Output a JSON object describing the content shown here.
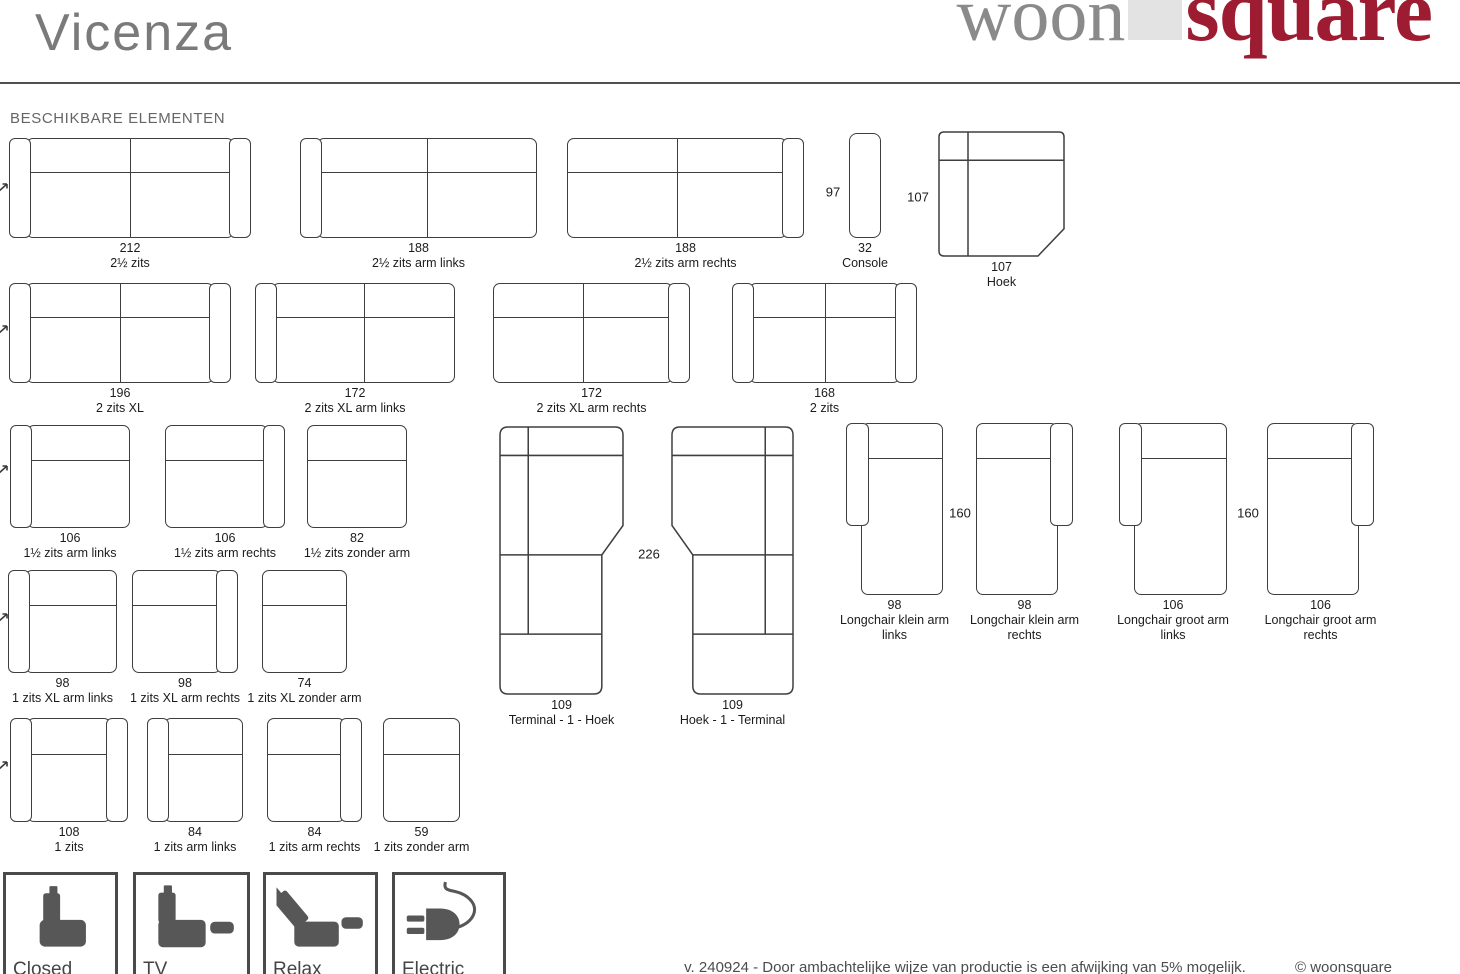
{
  "page": {
    "title": "Vicenza",
    "section_heading": "BESCHIKBARE ELEMENTEN"
  },
  "logo": {
    "part1": "woon",
    "part2": "square",
    "part1_color": "#8a8a8a",
    "part2_color": "#9d1c31",
    "square_color": "#e3e3e3"
  },
  "colors": {
    "line": "#3e3e3e",
    "label": "#1b1b1b",
    "icon": "#575757",
    "accent_red": "#9d1c31",
    "title_gray": "#7a7a7a"
  },
  "elements": [
    {
      "dim": "212",
      "label": "2½ zits",
      "type": "sofa",
      "arms": "both",
      "seats": 2,
      "x": 9,
      "y": 138,
      "w": 242,
      "h": 100
    },
    {
      "dim": "188",
      "label": "2½ zits arm links",
      "type": "sofa",
      "arms": "left",
      "seats": 2,
      "x": 300,
      "y": 138,
      "w": 237,
      "h": 100
    },
    {
      "dim": "188",
      "label": "2½ zits arm rechts",
      "type": "sofa",
      "arms": "right",
      "seats": 2,
      "x": 567,
      "y": 138,
      "w": 237,
      "h": 100
    },
    {
      "dim": "32",
      "label": "Console",
      "type": "console",
      "x": 849,
      "y": 133,
      "w": 32,
      "h": 105
    },
    {
      "dim": "107",
      "label": "Hoek",
      "type": "hoek",
      "x": 938,
      "y": 131,
      "w": 127,
      "h": 126
    },
    {
      "dim": "196",
      "label": "2 zits XL",
      "type": "sofa",
      "arms": "both",
      "seats": 2,
      "x": 9,
      "y": 283,
      "w": 222,
      "h": 100
    },
    {
      "dim": "172",
      "label": "2 zits XL arm links",
      "type": "sofa",
      "arms": "left",
      "seats": 2,
      "x": 255,
      "y": 283,
      "w": 200,
      "h": 100
    },
    {
      "dim": "172",
      "label": "2 zits XL arm rechts",
      "type": "sofa",
      "arms": "right",
      "seats": 2,
      "x": 493,
      "y": 283,
      "w": 197,
      "h": 100
    },
    {
      "dim": "168",
      "label": "2 zits",
      "type": "sofa",
      "arms": "both",
      "seats": 2,
      "x": 732,
      "y": 283,
      "w": 185,
      "h": 100
    },
    {
      "dim": "106",
      "label": "1½ zits arm links",
      "type": "sofa",
      "arms": "left",
      "seats": 1,
      "x": 10,
      "y": 425,
      "w": 120,
      "h": 103
    },
    {
      "dim": "106",
      "label": "1½ zits arm rechts",
      "type": "sofa",
      "arms": "right",
      "seats": 1,
      "x": 165,
      "y": 425,
      "w": 120,
      "h": 103
    },
    {
      "dim": "82",
      "label": "1½ zits zonder arm",
      "type": "sofa",
      "arms": "none",
      "seats": 1,
      "x": 307,
      "y": 425,
      "w": 100,
      "h": 103
    },
    {
      "dim": "109",
      "label": "Terminal - 1 - Hoek",
      "type": "terminal",
      "dir": "right",
      "x": 499,
      "y": 426,
      "w": 125,
      "h": 269
    },
    {
      "dim": "109",
      "label": "Hoek - 1 - Terminal",
      "type": "terminal",
      "dir": "left",
      "x": 671,
      "y": 426,
      "w": 123,
      "h": 269
    },
    {
      "dim": "98",
      "label": "Longchair klein arm links",
      "type": "longchair",
      "arm": "left",
      "x": 846,
      "y": 423,
      "w": 97,
      "h": 172,
      "labelw": 118
    },
    {
      "dim": "98",
      "label": "Longchair klein arm rechts",
      "type": "longchair",
      "arm": "right",
      "x": 976,
      "y": 423,
      "w": 97,
      "h": 172,
      "labelw": 118
    },
    {
      "dim": "106",
      "label": "Longchair groot arm links",
      "type": "longchair",
      "arm": "left",
      "x": 1119,
      "y": 423,
      "w": 108,
      "h": 172,
      "labelw": 118
    },
    {
      "dim": "106",
      "label": "Longchair groot arm rechts",
      "type": "longchair",
      "arm": "right",
      "x": 1267,
      "y": 423,
      "w": 107,
      "h": 172,
      "labelw": 118
    },
    {
      "dim": "98",
      "label": "1 zits XL arm links",
      "type": "sofa",
      "arms": "left",
      "seats": 1,
      "x": 8,
      "y": 570,
      "w": 109,
      "h": 103
    },
    {
      "dim": "98",
      "label": "1 zits XL arm rechts",
      "type": "sofa",
      "arms": "right",
      "seats": 1,
      "x": 132,
      "y": 570,
      "w": 106,
      "h": 103
    },
    {
      "dim": "74",
      "label": "1 zits XL zonder arm",
      "type": "sofa",
      "arms": "none",
      "seats": 1,
      "x": 262,
      "y": 570,
      "w": 85,
      "h": 103
    },
    {
      "dim": "108",
      "label": "1 zits",
      "type": "sofa",
      "arms": "both",
      "seats": 1,
      "x": 10,
      "y": 718,
      "w": 118,
      "h": 104
    },
    {
      "dim": "84",
      "label": "1 zits arm links",
      "type": "sofa",
      "arms": "left",
      "seats": 1,
      "x": 147,
      "y": 718,
      "w": 96,
      "h": 104
    },
    {
      "dim": "84",
      "label": "1 zits arm rechts",
      "type": "sofa",
      "arms": "right",
      "seats": 1,
      "x": 267,
      "y": 718,
      "w": 95,
      "h": 104
    },
    {
      "dim": "59",
      "label": "1 zits zonder arm",
      "type": "sofa",
      "arms": "none",
      "seats": 1,
      "x": 383,
      "y": 718,
      "w": 77,
      "h": 104
    }
  ],
  "dim_texts": [
    {
      "text": "97",
      "x": 833,
      "y": 192
    },
    {
      "text": "107",
      "x": 918,
      "y": 197
    },
    {
      "text": "226",
      "x": 649,
      "y": 554
    },
    {
      "text": "160",
      "x": 960,
      "y": 513
    },
    {
      "text": "160",
      "x": 1248,
      "y": 513
    }
  ],
  "cut_marks": [
    {
      "y": 186
    },
    {
      "y": 328
    },
    {
      "y": 468
    },
    {
      "y": 616
    },
    {
      "y": 764
    }
  ],
  "features": [
    {
      "label": "Closed",
      "icon": "closed-position-icon",
      "x": 3,
      "w": 115
    },
    {
      "label": "TV",
      "icon": "tv-position-icon",
      "x": 133,
      "w": 117
    },
    {
      "label": "Relax",
      "icon": "relax-position-icon",
      "x": 263,
      "w": 115
    },
    {
      "label": "Electric",
      "icon": "electric-plug-icon",
      "x": 392,
      "w": 114
    }
  ],
  "footer": {
    "note": "v. 240924 - Door ambachtelijke wijze van productie is een afwijking van 5% mogelijk.",
    "copyright": "© woonsquare"
  }
}
